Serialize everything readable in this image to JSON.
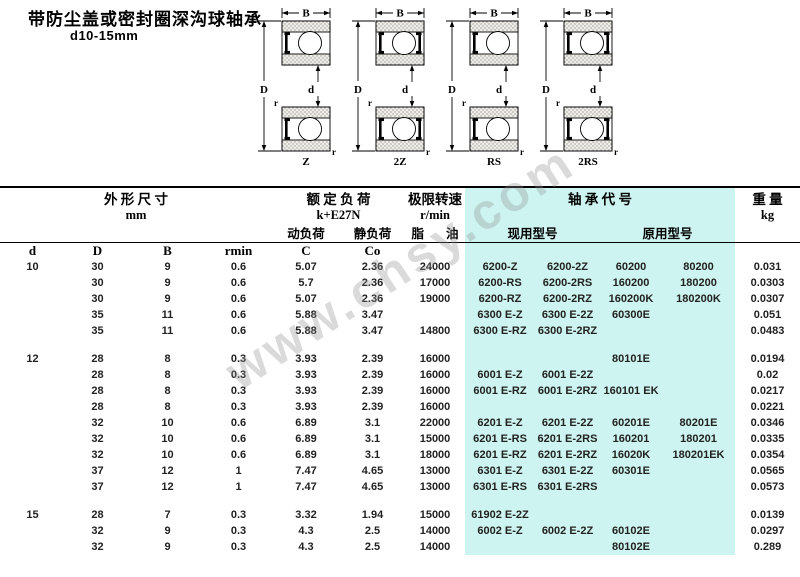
{
  "title": "带防尘盖或密封圈深沟球轴承",
  "subtitle": "d10-15mm",
  "watermark": "www.chsy.com",
  "colors": {
    "highlight": "#cdf4f0"
  },
  "figure_dims": {
    "width_label": "B",
    "outer_label": "D",
    "bore_label": "d",
    "fillet_label": "r"
  },
  "figures": [
    {
      "label": "Z",
      "double": false
    },
    {
      "label": "2Z",
      "double": true
    },
    {
      "label": "RS",
      "double": false
    },
    {
      "label": "2RS",
      "double": true
    }
  ],
  "table": {
    "header": {
      "dims_group": "外 形 尺 寸",
      "dims_unit": "mm",
      "load_group": "额 定 负 荷",
      "load_unit": "k+E27N",
      "load_dynamic": "动负荷",
      "load_static": "静负荷",
      "speed_group": "极限转速",
      "speed_unit": "r/min",
      "speed_grease": "脂",
      "speed_oil": "油",
      "code_group": "轴 承 代 号",
      "code_current": "现用型号",
      "code_original": "原用型号",
      "weight_group": "重 量",
      "weight_unit": "kg",
      "d": "d",
      "D": "D",
      "B": "B",
      "rmin": "rmin",
      "C": "C",
      "Co": "Co"
    },
    "groups": [
      {
        "rows": [
          [
            "10",
            "30",
            "9",
            "0.6",
            "5.07",
            "2.36",
            "24000",
            "6200-Z",
            "6200-2Z",
            "60200",
            "80200",
            "0.031"
          ],
          [
            "",
            "30",
            "9",
            "0.6",
            "5.7",
            "2.36",
            "17000",
            "6200-RS",
            "6200-2RS",
            "160200",
            "180200",
            "0.0303"
          ],
          [
            "",
            "30",
            "9",
            "0.6",
            "5.07",
            "2.36",
            "19000",
            "6200-RZ",
            "6200-2RZ",
            "160200K",
            "180200K",
            "0.0307"
          ],
          [
            "",
            "35",
            "11",
            "0.6",
            "5.88",
            "3.47",
            "",
            "6300 E-Z",
            "6300 E-2Z",
            "60300E",
            "",
            "0.051"
          ],
          [
            "",
            "35",
            "11",
            "0.6",
            "5.88",
            "3.47",
            "14800",
            "6300 E-RZ",
            "6300 E-2RZ",
            "",
            "",
            "0.0483"
          ]
        ]
      },
      {
        "rows": [
          [
            "12",
            "28",
            "8",
            "0.3",
            "3.93",
            "2.39",
            "16000",
            "",
            "",
            "80101E",
            "",
            "0.0194"
          ],
          [
            "",
            "28",
            "8",
            "0.3",
            "3.93",
            "2.39",
            "16000",
            "6001 E-Z",
            "6001 E-2Z",
            "",
            "",
            "0.02"
          ],
          [
            "",
            "28",
            "8",
            "0.3",
            "3.93",
            "2.39",
            "16000",
            "6001 E-RZ",
            "6001 E-2RZ",
            "160101 EK",
            "",
            "0.0217"
          ],
          [
            "",
            "28",
            "8",
            "0.3",
            "3.93",
            "2.39",
            "16000",
            "",
            "",
            "",
            "",
            "0.0221"
          ],
          [
            "",
            "32",
            "10",
            "0.6",
            "6.89",
            "3.1",
            "22000",
            "6201 E-Z",
            "6201 E-2Z",
            "60201E",
            "80201E",
            "0.0346"
          ],
          [
            "",
            "32",
            "10",
            "0.6",
            "6.89",
            "3.1",
            "15000",
            "6201 E-RS",
            "6201 E-2RS",
            "160201",
            "180201",
            "0.0335"
          ],
          [
            "",
            "32",
            "10",
            "0.6",
            "6.89",
            "3.1",
            "18000",
            "6201 E-RZ",
            "6201 E-2RZ",
            "16020K",
            "180201EK",
            "0.0354"
          ],
          [
            "",
            "37",
            "12",
            "1",
            "7.47",
            "4.65",
            "13000",
            "6301 E-Z",
            "6301 E-2Z",
            "60301E",
            "",
            "0.0565"
          ],
          [
            "",
            "37",
            "12",
            "1",
            "7.47",
            "4.65",
            "13000",
            "6301 E-RS",
            "6301 E-2RS",
            "",
            "",
            "0.0573"
          ]
        ]
      },
      {
        "rows": [
          [
            "15",
            "28",
            "7",
            "0.3",
            "3.32",
            "1.94",
            "15000",
            "61902 E-2Z",
            "",
            "",
            "",
            "0.0139"
          ],
          [
            "",
            "32",
            "9",
            "0.3",
            "4.3",
            "2.5",
            "14000",
            "6002 E-Z",
            "6002 E-2Z",
            "60102E",
            "",
            "0.0297"
          ],
          [
            "",
            "32",
            "9",
            "0.3",
            "4.3",
            "2.5",
            "14000",
            "",
            "",
            "80102E",
            "",
            "0.289"
          ]
        ]
      }
    ]
  }
}
